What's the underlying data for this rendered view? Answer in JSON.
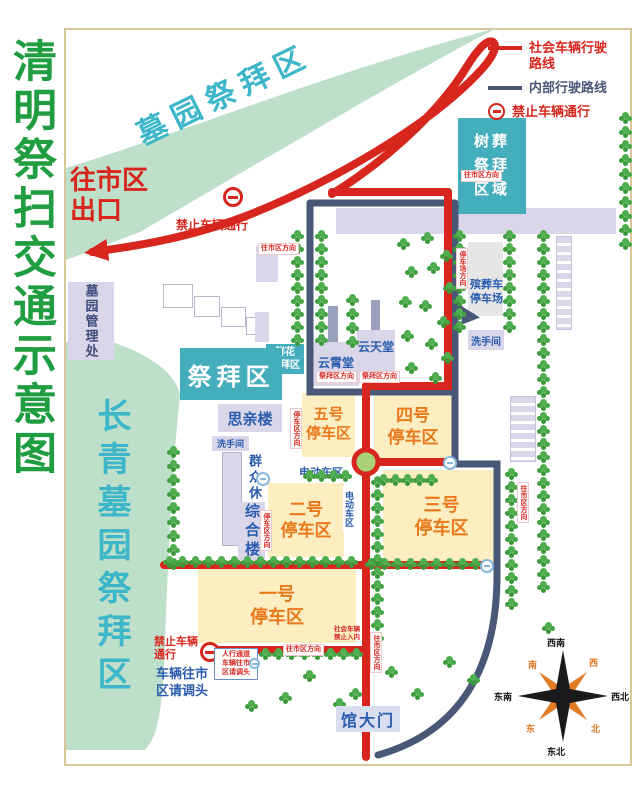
{
  "title": "清明祭扫交通示意图",
  "legend": {
    "social": "社会车辆行驶路线",
    "internal": "内部行驶路线",
    "no_entry": "禁止车辆通行"
  },
  "bands": {
    "top": "墓园祭拜区",
    "left": "长青墓园祭拜区"
  },
  "areas": {
    "tree_burial": [
      "树葬",
      "祭拜",
      "区域"
    ],
    "worship": "祭拜区",
    "flower": [
      "鲜花",
      "祭拜区"
    ],
    "yunxiao": "云霄堂",
    "yuntian": "云天堂",
    "siqin": "思亲楼",
    "rest_zone": "群众休息区",
    "complex": "综合楼",
    "management": "墓园管理处",
    "funeral_parking": [
      "殡葬车",
      "停车场"
    ],
    "restroom_right": "洗手间",
    "restroom_left": "洗手间",
    "ev_area": "电动车区",
    "ev_area_side": "电动车区",
    "gate": "馆大门"
  },
  "parking": {
    "p1": [
      "一号",
      "停车区"
    ],
    "p2": [
      "二号",
      "停车区"
    ],
    "p3": [
      "三号",
      "停车区"
    ],
    "p4": [
      "四号",
      "停车区"
    ],
    "p5": [
      "五号",
      "停车区"
    ]
  },
  "notices": {
    "exit_l1": "往市区",
    "exit_l2": "出口",
    "no_entry_top": "禁止车辆通行",
    "no_entry_bottom": [
      "禁止车辆",
      "通行"
    ],
    "uturn": [
      "车辆往市",
      "区请调头"
    ],
    "pedestrian": [
      "人行通道",
      "车辆往市",
      "区请调头"
    ],
    "social_ban": [
      "社会车辆",
      "禁止入内"
    ]
  },
  "compass": {
    "top": "西南",
    "bottom": "东北",
    "left": "东南",
    "right": "西北",
    "nw": "南",
    "ne": "西",
    "sw": "东",
    "se": "北"
  },
  "small_labels": [
    {
      "t": "往市区方向",
      "x": 258,
      "y": 243,
      "v": false
    },
    {
      "t": "往市区方向",
      "x": 461,
      "y": 170,
      "v": false
    },
    {
      "t": "停车场方向",
      "x": 456,
      "y": 248,
      "v": true
    },
    {
      "t": "往市区方向",
      "x": 517,
      "y": 482,
      "v": true
    },
    {
      "t": "祭拜区方向",
      "x": 316,
      "y": 371,
      "v": false
    },
    {
      "t": "祭拜区方向",
      "x": 359,
      "y": 371,
      "v": false
    },
    {
      "t": "往市区方向",
      "x": 283,
      "y": 644,
      "v": false
    },
    {
      "t": "往市区方向",
      "x": 370,
      "y": 632,
      "v": true
    },
    {
      "t": "停车区方向",
      "x": 290,
      "y": 408,
      "v": true
    },
    {
      "t": "停车区方向",
      "x": 260,
      "y": 510,
      "v": true
    }
  ],
  "vegetation": {
    "rows": [
      [
        170,
        446,
        0,
        14,
        9
      ],
      [
        166,
        556,
        13,
        0,
        15
      ],
      [
        368,
        558,
        13,
        0,
        9
      ],
      [
        262,
        648,
        13,
        0,
        8
      ],
      [
        374,
        476,
        0,
        13,
        13
      ],
      [
        294,
        230,
        0,
        13,
        9
      ],
      [
        318,
        230,
        0,
        13,
        9
      ],
      [
        349,
        294,
        0,
        14,
        4
      ],
      [
        456,
        230,
        0,
        13,
        8
      ],
      [
        506,
        230,
        0,
        13,
        8
      ],
      [
        540,
        230,
        0,
        13,
        28
      ],
      [
        508,
        468,
        0,
        13,
        11
      ],
      [
        622,
        112,
        0,
        14,
        10
      ],
      [
        306,
        470,
        12,
        0,
        4
      ],
      [
        380,
        474,
        12,
        0,
        5
      ]
    ],
    "scatter": [
      [
        400,
        238
      ],
      [
        424,
        232
      ],
      [
        443,
        250
      ],
      [
        408,
        266
      ],
      [
        430,
        262
      ],
      [
        446,
        282
      ],
      [
        402,
        296
      ],
      [
        422,
        300
      ],
      [
        440,
        316
      ],
      [
        404,
        330
      ],
      [
        428,
        338
      ],
      [
        444,
        352
      ],
      [
        408,
        362
      ],
      [
        432,
        372
      ],
      [
        282,
        692
      ],
      [
        306,
        670
      ],
      [
        336,
        698
      ],
      [
        352,
        688
      ],
      [
        388,
        666
      ],
      [
        414,
        688
      ],
      [
        446,
        656
      ],
      [
        470,
        674
      ],
      [
        545,
        622
      ],
      [
        248,
        700
      ]
    ]
  },
  "colors": {
    "route_social": "#d7261e",
    "route_internal": "#4a5878",
    "band_green": "#bedfc9",
    "teal_text": "#3cb6c8",
    "teal_box": "#45aebc",
    "title_green": "#1f9d40",
    "parking_fill": "#fdeec2",
    "parking_text": "#e8791b",
    "building_fill": "#d9d6ea",
    "label_blue": "#2b5cad"
  }
}
